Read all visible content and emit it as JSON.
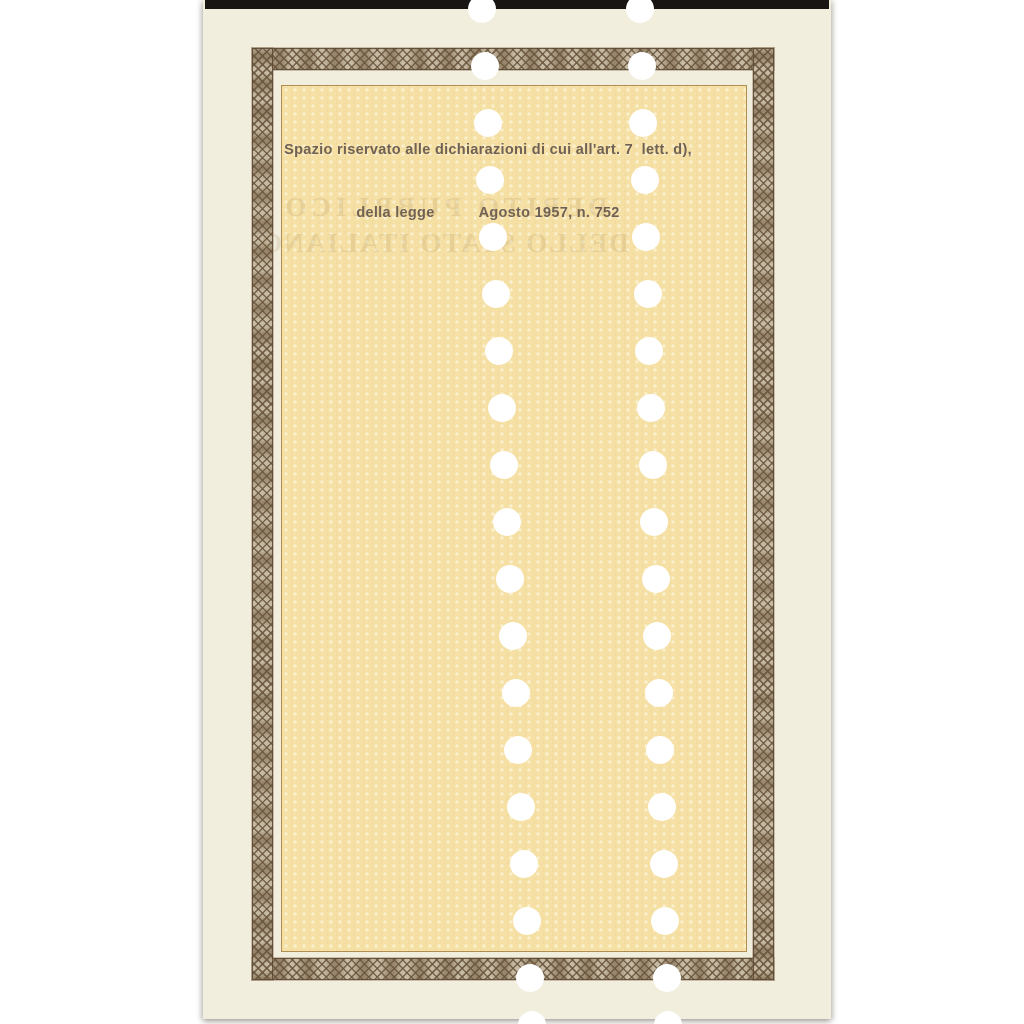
{
  "document": {
    "kind": "back of Italian public-debt certificate, punched (annulled), scanned on white"
  },
  "declaration": {
    "line1": "Spazio riservato alle dichiarazioni di cui all'art. 7  lett. d),",
    "line2_left": "della legge",
    "line2_right": "Agosto 1957, n. 752"
  },
  "ghost": {
    "line1": "DEBITO PUBBLICO",
    "line2": "DELLO STATO ITALIANO"
  },
  "colors": {
    "page-bg": "#ffffff",
    "paper": "#f2eedd",
    "field": "#f5dfa2",
    "field-line": "#b08f52",
    "band-base": "#b7a78a",
    "black-bar": "#191512",
    "ink": "#6f6155",
    "hole": "#ffffff"
  },
  "holes": {
    "radius": 14,
    "y_top": 9,
    "y_bottom": 1025,
    "ys": [
      9,
      66,
      123,
      180,
      237,
      294,
      351,
      408,
      465,
      522,
      579,
      636,
      693,
      750,
      807,
      864,
      921,
      978,
      1025
    ],
    "columns": [
      {
        "name": "left",
        "x_top": 482,
        "x_bottom": 532
      },
      {
        "name": "right",
        "x_top": 640,
        "x_bottom": 668
      }
    ]
  }
}
